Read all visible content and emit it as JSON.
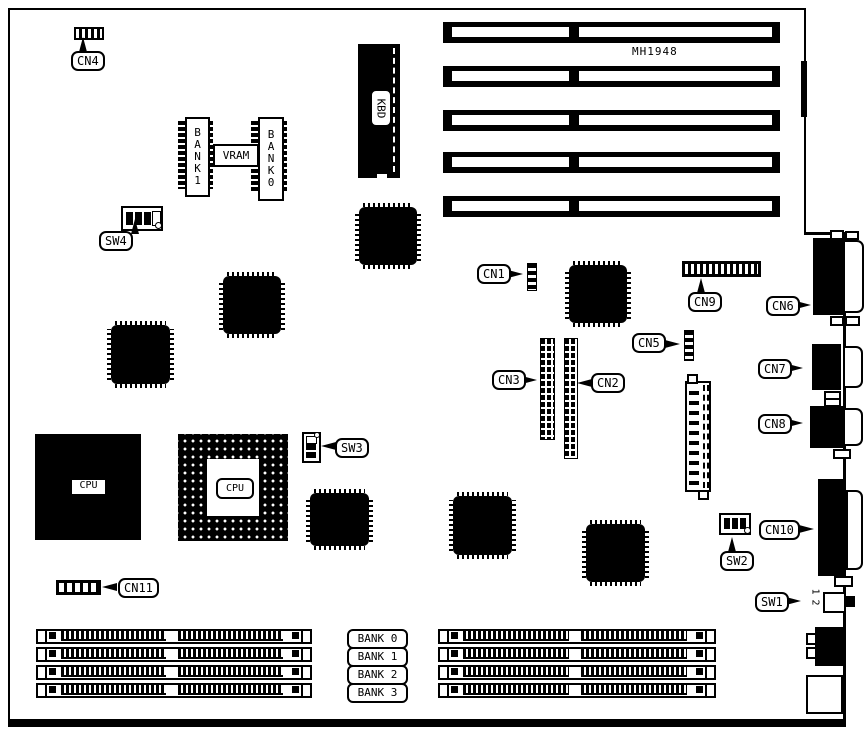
{
  "diagram": {
    "title_code": "MH1948",
    "connector_labels": {
      "cn1": "CN1",
      "cn2": "CN2",
      "cn3": "CN3",
      "cn4": "CN4",
      "cn5": "CN5",
      "cn6": "CN6",
      "cn7": "CN7",
      "cn8": "CN8",
      "cn9": "CN9",
      "cn10": "CN10",
      "cn11": "CN11"
    },
    "switch_labels": {
      "sw1": "SW1",
      "sw2": "SW2",
      "sw3": "SW3",
      "sw4": "SW4"
    },
    "chip_labels": {
      "kbd": "KBD",
      "vram": "VRAM",
      "cpu_main": "CPU",
      "cpu_socket": "CPU"
    },
    "vram_bank_modules": {
      "bank1": "BANK1",
      "bank0": "BANK0"
    },
    "memory_bank_labels": [
      "BANK 0",
      "BANK 1",
      "BANK 2",
      "BANK 3"
    ],
    "sw1_positions": {
      "p1": "1",
      "p2": "2"
    },
    "colors": {
      "ink": "#000000",
      "paper": "#ffffff"
    }
  }
}
